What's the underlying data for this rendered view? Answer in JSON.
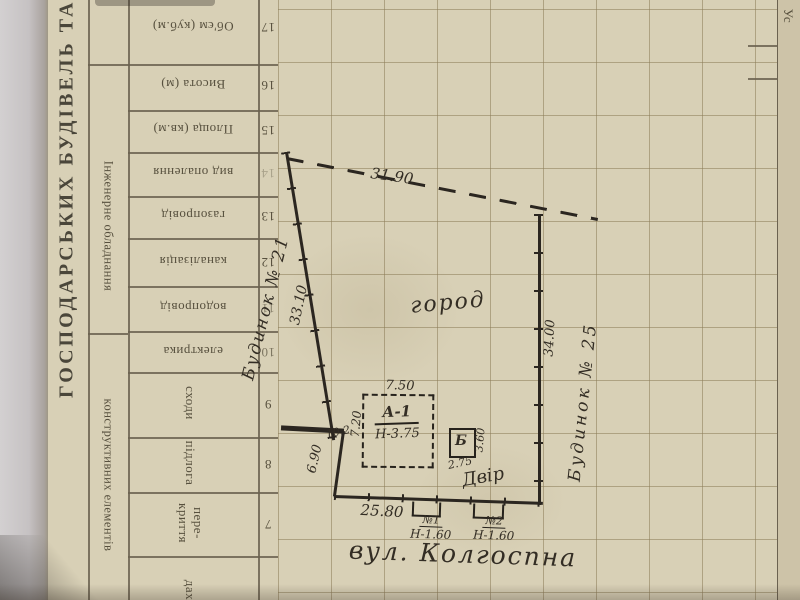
{
  "side": {
    "edge_title": "ГОСПОДАРСЬКИХ БУДІВЕЛЬ ТА С",
    "band_utilities": "Інженерне обладнання",
    "band_construction": "конструктивних елементів"
  },
  "corner": {
    "label": "Ус"
  },
  "table": {
    "rows": [
      {
        "num": "17",
        "label": "Об'єм (куб.м)"
      },
      {
        "num": "16",
        "label": "Висота (м)"
      },
      {
        "num": "15",
        "label": "Площа (кв.м)"
      },
      {
        "num": "14",
        "label": "вид опалення"
      },
      {
        "num": "13",
        "label": "газопровід"
      },
      {
        "num": "12",
        "label": "каналізація"
      },
      {
        "num": "11",
        "label": "водопровід"
      },
      {
        "num": "10",
        "label": "електрика"
      },
      {
        "num": "9",
        "label": "сходи"
      },
      {
        "num": "8",
        "label": "підлога"
      },
      {
        "num": "7",
        "label": "пере-криття"
      },
      {
        "num": "",
        "label": "дах"
      }
    ]
  },
  "plan": {
    "garden_label": "город",
    "yard_label": "Двір",
    "street_label": "вул. Колгоспна",
    "neighbor_left": "Будинок № 21",
    "neighbor_right": "Будинок № 25",
    "dim_top": "31.90",
    "dim_left": "33.10",
    "dim_right": "34.00",
    "dim_bottom": "25.80",
    "dim_bottom_left": "6.90",
    "dim_setback": "10.2",
    "building_a": {
      "label": "А-1",
      "height": "Н-3.75",
      "dim_top": "7.50",
      "dim_side": "7.20"
    },
    "building_b": {
      "label": "Б",
      "dim_side": "3.60",
      "dim_bottom": "2.75"
    },
    "gate_1": {
      "label": "№1",
      "height": "Н-1.60"
    },
    "gate_2": {
      "label": "№2",
      "height": "Н-1.60"
    }
  }
}
